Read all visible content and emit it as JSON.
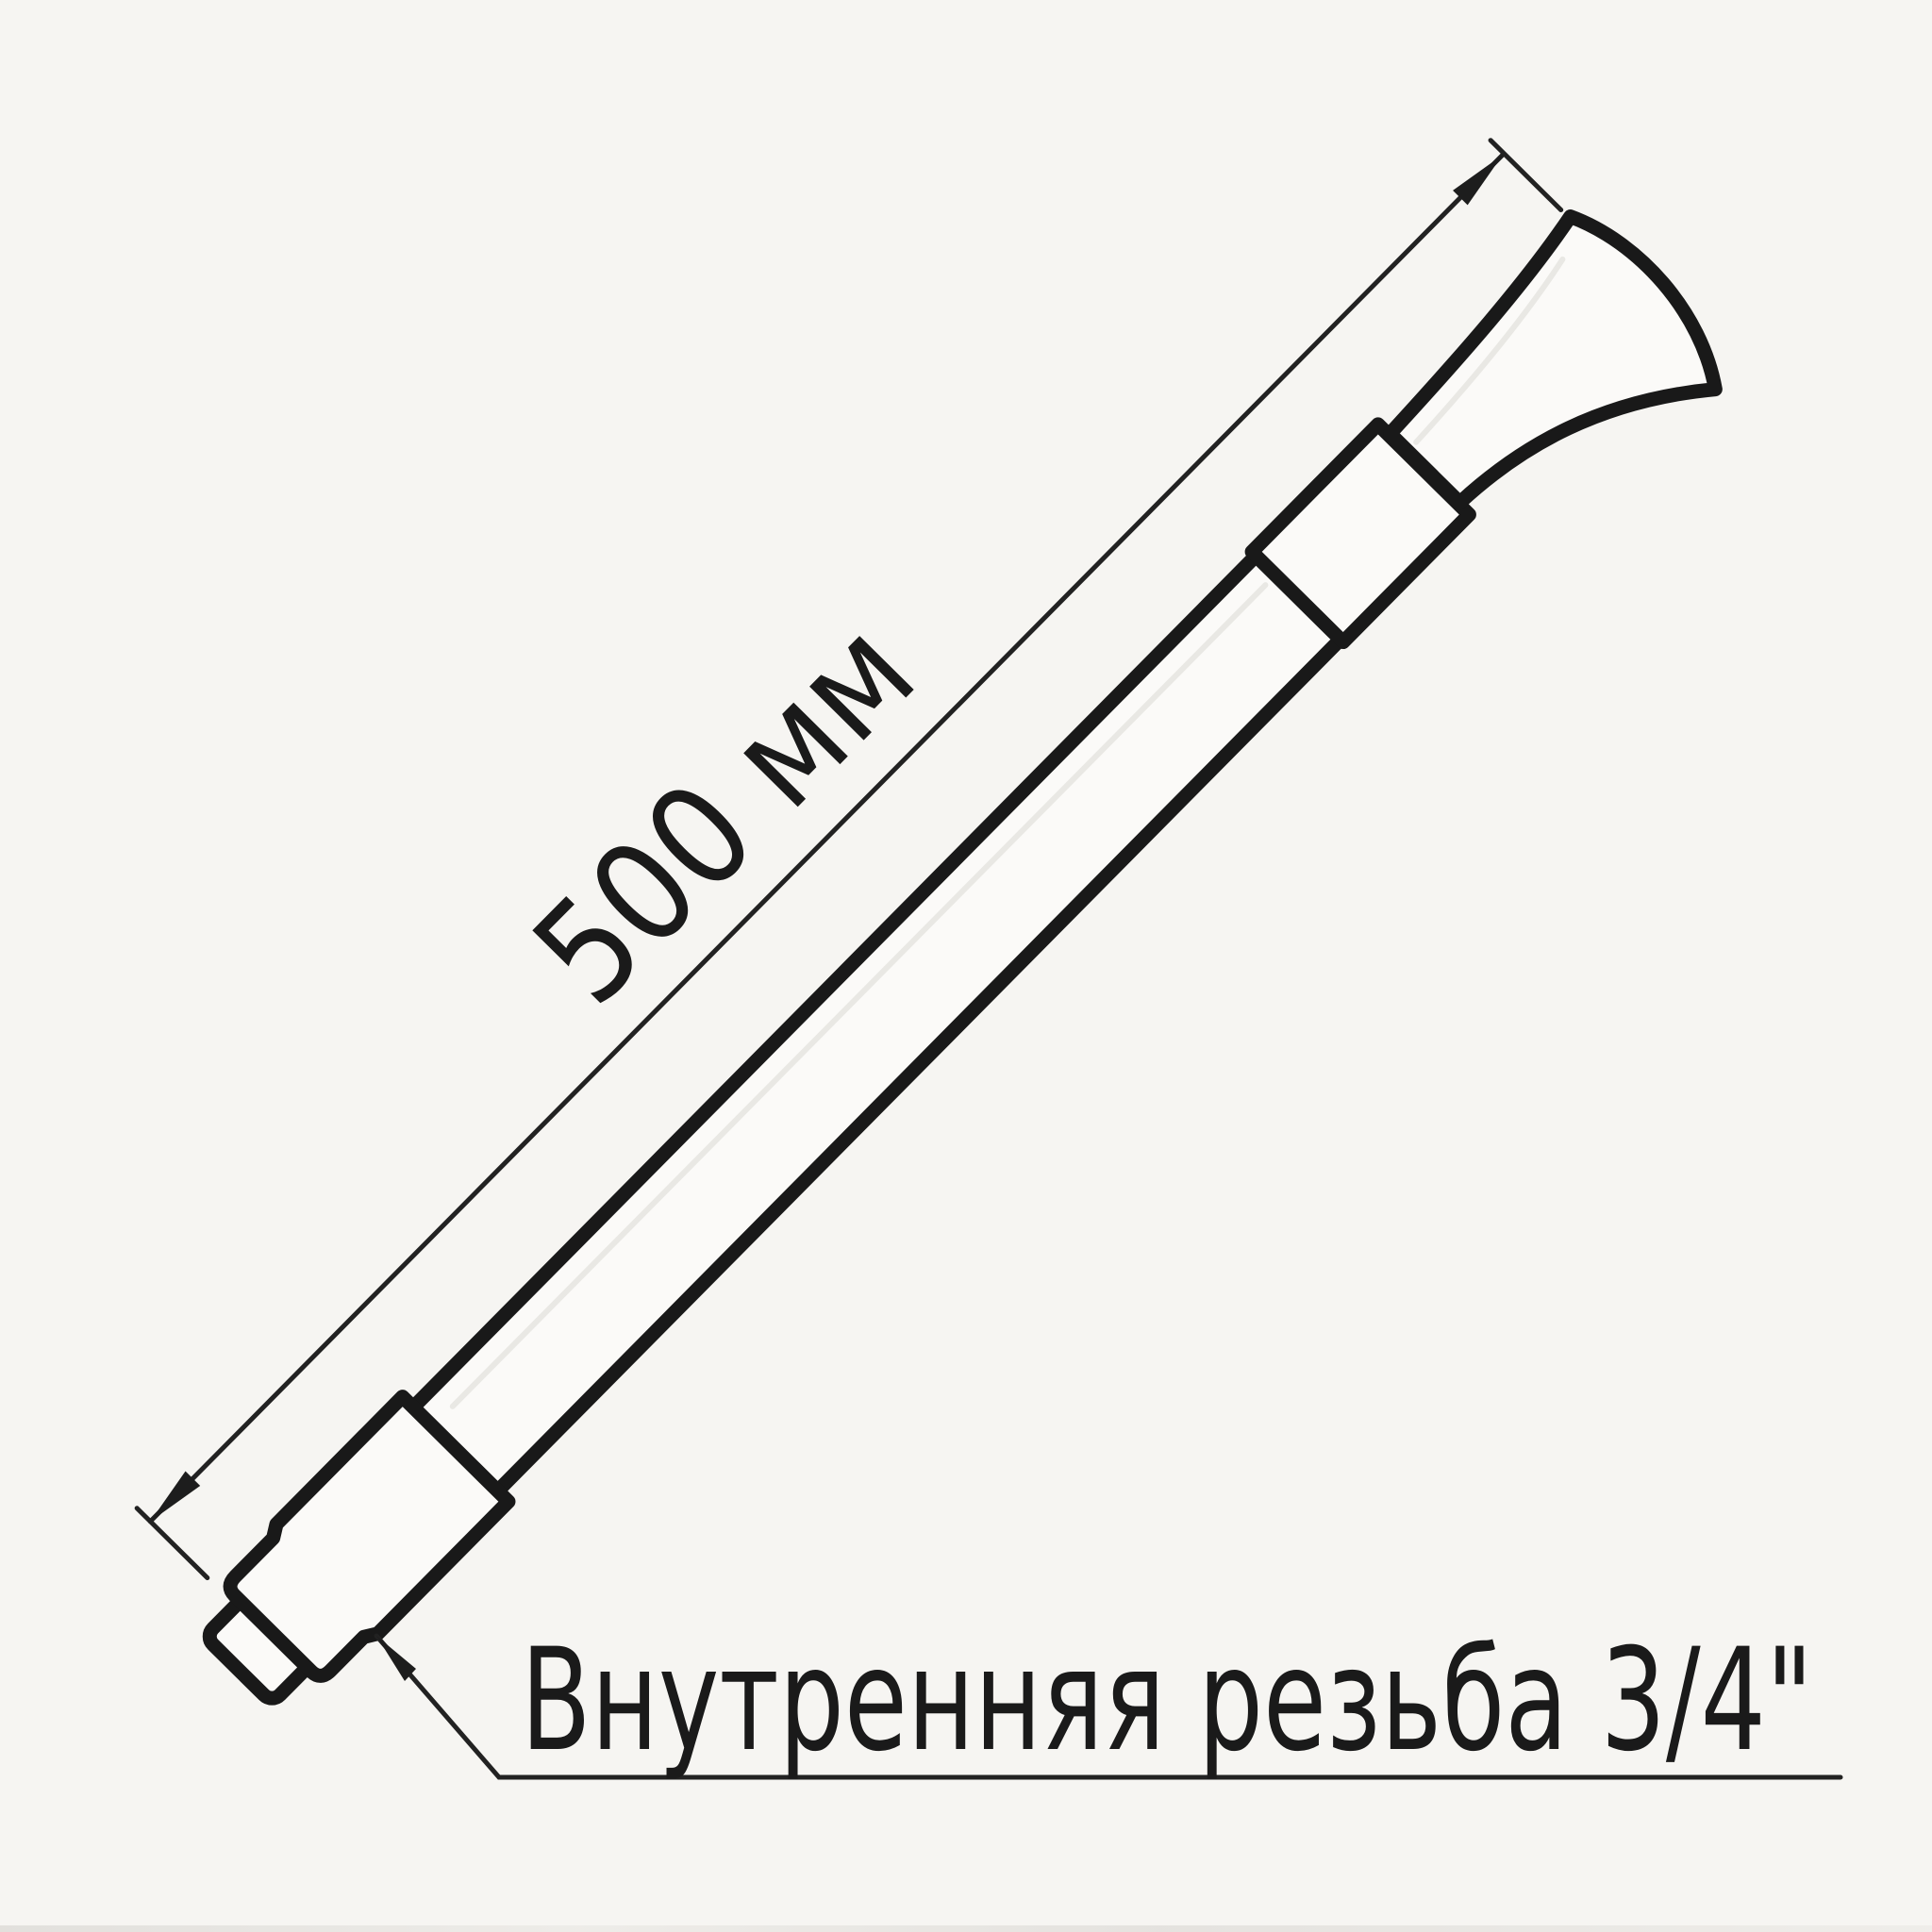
{
  "page": {
    "background_color": "#f6f5f2",
    "kind": "technical line drawing, scanned"
  },
  "drawing": {
    "dimension": {
      "label": "500 мм",
      "value_mm": 500
    },
    "annotation": {
      "label": "Внутренняя резьба 3/4\"",
      "thread_size": "3/4\""
    },
    "parts": {
      "hose": "flexible hose body",
      "nut": "hex socket nut with threaded nipple",
      "collar": "cylindrical collar",
      "bell": "conical handle end"
    },
    "colors": {
      "outline": "#191919",
      "thin_line": "#222222",
      "fill": "#fbfaf8",
      "highlight": "#e9e8e4",
      "background": "#f6f5f2"
    }
  }
}
